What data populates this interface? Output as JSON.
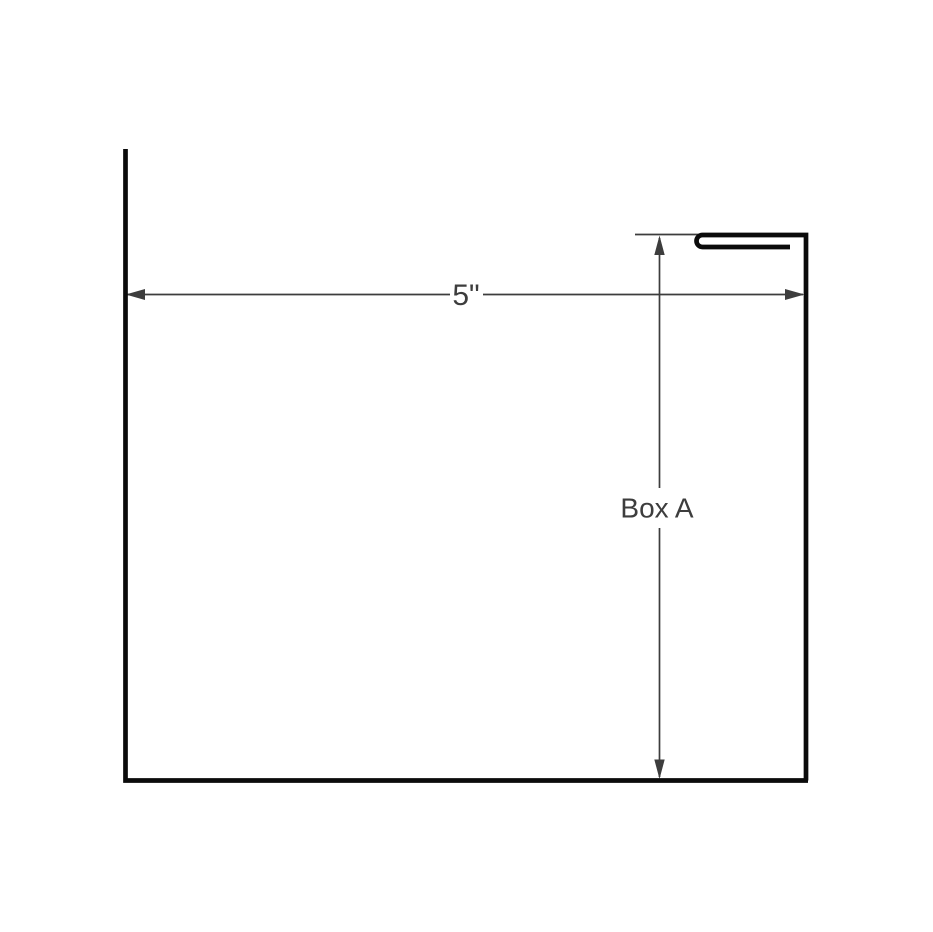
{
  "drawing": {
    "width_dimension": {
      "label": "5\""
    },
    "part_label": {
      "label": "Box A"
    }
  },
  "colors": {
    "background": "#ffffff",
    "profile": "#0b0b0b",
    "dimension": "#3d3d3d"
  }
}
